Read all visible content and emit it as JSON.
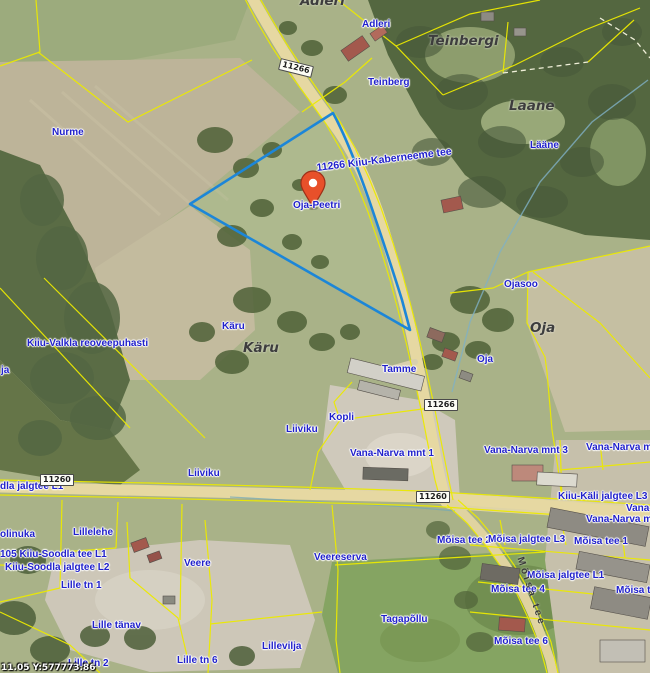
{
  "map": {
    "selected_parcel_label": "Oja-Peetri",
    "coordinate_readout": "11.05 Y:577773.86",
    "colors": {
      "address_label": "#2121cc",
      "parcel_outline": "#1c86d8",
      "cadastral_line": "#ecea00",
      "marker": "#e8502a",
      "road_fill": "#e6d8a2"
    },
    "labels": [
      {
        "text": "Adleri",
        "x": 300,
        "y": -6,
        "type": "cad"
      },
      {
        "text": "Adleri",
        "x": 362,
        "y": 20,
        "type": "addr"
      },
      {
        "text": "Teinbergi",
        "x": 428,
        "y": 34,
        "type": "cad"
      },
      {
        "text": "Teinberg",
        "x": 368,
        "y": 78,
        "type": "addr"
      },
      {
        "text": "Laane",
        "x": 509,
        "y": 99,
        "type": "cad"
      },
      {
        "text": "Lääne",
        "x": 530,
        "y": 141,
        "type": "addr"
      },
      {
        "text": "Nurme",
        "x": 52,
        "y": 128,
        "type": "addr"
      },
      {
        "text": "11266 Kiiu-Kaberneeme tee",
        "x": 316,
        "y": 163,
        "type": "roadname",
        "rot": -7
      },
      {
        "text": "Oja-Peetri",
        "x": 293,
        "y": 201,
        "type": "addr"
      },
      {
        "text": "Ojasoo",
        "x": 504,
        "y": 280,
        "type": "addr"
      },
      {
        "text": "Oja",
        "x": 530,
        "y": 321,
        "type": "cad"
      },
      {
        "text": "Oja",
        "x": 477,
        "y": 355,
        "type": "addr"
      },
      {
        "text": "Käru",
        "x": 222,
        "y": 322,
        "type": "addr"
      },
      {
        "text": "Käru",
        "x": 243,
        "y": 341,
        "type": "cad"
      },
      {
        "text": "Kiiu-Valkla reoveepuhasti",
        "x": 27,
        "y": 339,
        "type": "addr"
      },
      {
        "text": "ja",
        "x": 1,
        "y": 366,
        "type": "addr"
      },
      {
        "text": "Tamme",
        "x": 382,
        "y": 365,
        "type": "addr"
      },
      {
        "text": "Kopli",
        "x": 329,
        "y": 413,
        "type": "addr"
      },
      {
        "text": "Liiviku",
        "x": 286,
        "y": 425,
        "type": "addr"
      },
      {
        "text": "Liiviku",
        "x": 188,
        "y": 469,
        "type": "addr"
      },
      {
        "text": "Vana-Narva mnt 1",
        "x": 350,
        "y": 449,
        "type": "addr"
      },
      {
        "text": "Vana-Narva mnt 3",
        "x": 484,
        "y": 446,
        "type": "addr"
      },
      {
        "text": "Vana-Narva mnt",
        "x": 586,
        "y": 443,
        "type": "addr"
      },
      {
        "text": "dla jalgtee L1",
        "x": 0,
        "y": 482,
        "type": "addr"
      },
      {
        "text": "Kiiu-Käli jalgtee L3",
        "x": 558,
        "y": 492,
        "type": "addr"
      },
      {
        "text": "Vana-",
        "x": 626,
        "y": 504,
        "type": "addr"
      },
      {
        "text": "Vana-Narva mnt",
        "x": 586,
        "y": 515,
        "type": "addr"
      },
      {
        "text": "olinuka",
        "x": 0,
        "y": 530,
        "type": "addr"
      },
      {
        "text": "Lillelehe",
        "x": 73,
        "y": 528,
        "type": "addr"
      },
      {
        "text": "Mõisa tee 2",
        "x": 437,
        "y": 536,
        "type": "addr"
      },
      {
        "text": "Mõisa jalgtee L3",
        "x": 488,
        "y": 535,
        "type": "addr"
      },
      {
        "text": "Mõisa tee 1",
        "x": 574,
        "y": 537,
        "type": "addr"
      },
      {
        "text": "105 Kiiu-Soodla tee L1",
        "x": 0,
        "y": 550,
        "type": "addr"
      },
      {
        "text": "Veere",
        "x": 184,
        "y": 559,
        "type": "addr"
      },
      {
        "text": "Veereserva",
        "x": 314,
        "y": 553,
        "type": "addr"
      },
      {
        "text": "Kiiu-Soodla jalgtee L2",
        "x": 5,
        "y": 563,
        "type": "addr"
      },
      {
        "text": "Mõisa jalgtee L1",
        "x": 527,
        "y": 571,
        "type": "addr"
      },
      {
        "text": "Lille tn 1",
        "x": 61,
        "y": 581,
        "type": "addr"
      },
      {
        "text": "Mõisa tee 4",
        "x": 491,
        "y": 585,
        "type": "addr"
      },
      {
        "text": "Mõisa te",
        "x": 616,
        "y": 586,
        "type": "addr"
      },
      {
        "text": "Mõisa tee",
        "x": 524,
        "y": 556,
        "type": "street",
        "rot": 72
      },
      {
        "text": "Tagapõllu",
        "x": 381,
        "y": 615,
        "type": "addr"
      },
      {
        "text": "Lille tänav",
        "x": 92,
        "y": 621,
        "type": "addr"
      },
      {
        "text": "Mõisa tee 6",
        "x": 494,
        "y": 637,
        "type": "addr"
      },
      {
        "text": "Lillevilja",
        "x": 262,
        "y": 642,
        "type": "addr"
      },
      {
        "text": "Lille tn 2",
        "x": 68,
        "y": 659,
        "type": "addr"
      },
      {
        "text": "Lille tn 6",
        "x": 177,
        "y": 656,
        "type": "addr"
      }
    ],
    "road_shields": [
      {
        "text": "11266",
        "x": 279,
        "y": 62,
        "rot": 14
      },
      {
        "text": "11266",
        "x": 424,
        "y": 399,
        "rot": 0
      },
      {
        "text": "11260",
        "x": 416,
        "y": 491,
        "rot": 0
      },
      {
        "text": "11260",
        "x": 40,
        "y": 474,
        "rot": 0
      }
    ]
  }
}
